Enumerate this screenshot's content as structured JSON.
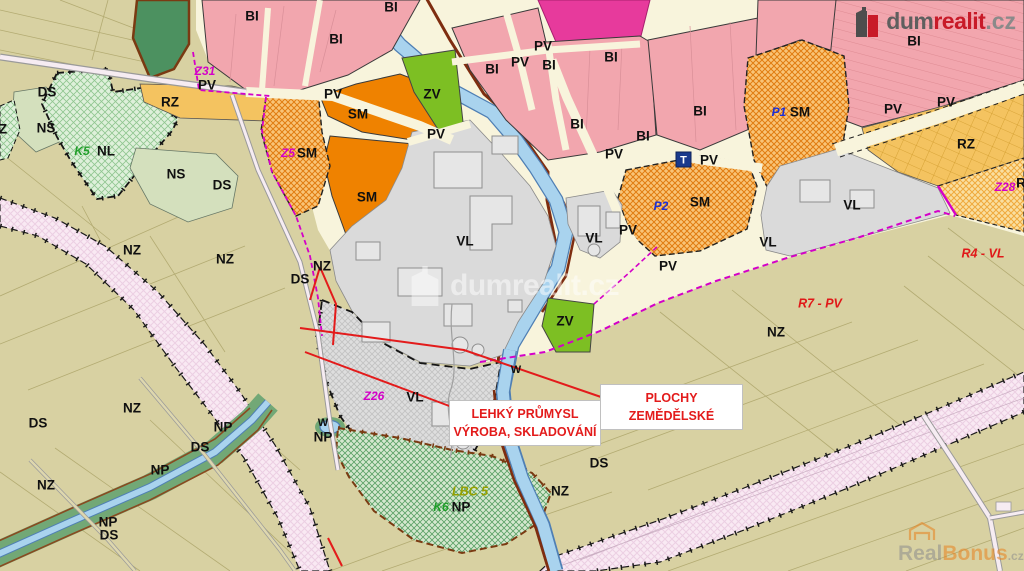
{
  "branding": {
    "logo": {
      "part1": "dum",
      "part2": "realit",
      "part3": ".cz"
    },
    "watermark_center": "dumrealit.cz",
    "watermark_bottom": {
      "part1": "Real",
      "part2": "Bonus",
      "part3": ".cz"
    }
  },
  "annotations": {
    "industry": {
      "line1": "LEHKÝ PRŮMYSL",
      "line2": "VÝROBA, SKLADOVÁNÍ"
    },
    "agriculture": {
      "line1": "PLOCHY",
      "line2": "ZEMĚDĚLSKÉ"
    }
  },
  "map": {
    "t_icon_label": "T",
    "zone_labels": [
      {
        "t": "BI",
        "x": 252,
        "y": 17,
        "c": "z"
      },
      {
        "t": "BI",
        "x": 391,
        "y": 8,
        "c": "z"
      },
      {
        "t": "BI",
        "x": 336,
        "y": 40,
        "c": "z"
      },
      {
        "t": "BI",
        "x": 914,
        "y": 42,
        "c": "z"
      },
      {
        "t": "BI",
        "x": 492,
        "y": 70,
        "c": "z"
      },
      {
        "t": "BI",
        "x": 549,
        "y": 66,
        "c": "z"
      },
      {
        "t": "BI",
        "x": 611,
        "y": 58,
        "c": "z"
      },
      {
        "t": "BI",
        "x": 577,
        "y": 125,
        "c": "z"
      },
      {
        "t": "BI",
        "x": 643,
        "y": 137,
        "c": "z"
      },
      {
        "t": "BI",
        "x": 700,
        "y": 112,
        "c": "z"
      },
      {
        "t": "PV",
        "x": 543,
        "y": 47,
        "c": "z"
      },
      {
        "t": "PV",
        "x": 520,
        "y": 63,
        "c": "z"
      },
      {
        "t": "PV",
        "x": 207,
        "y": 86,
        "c": "z"
      },
      {
        "t": "PV",
        "x": 333,
        "y": 95,
        "c": "z"
      },
      {
        "t": "PV",
        "x": 436,
        "y": 135,
        "c": "z"
      },
      {
        "t": "PV",
        "x": 614,
        "y": 155,
        "c": "z"
      },
      {
        "t": "PV",
        "x": 709,
        "y": 161,
        "c": "z"
      },
      {
        "t": "PV",
        "x": 893,
        "y": 110,
        "c": "z"
      },
      {
        "t": "PV",
        "x": 946,
        "y": 103,
        "c": "z"
      },
      {
        "t": "PV",
        "x": 628,
        "y": 231,
        "c": "z"
      },
      {
        "t": "PV",
        "x": 668,
        "y": 267,
        "c": "z"
      },
      {
        "t": "RZ",
        "x": 170,
        "y": 103,
        "c": "z"
      },
      {
        "t": "RZ",
        "x": 966,
        "y": 145,
        "c": "z"
      },
      {
        "t": "SM",
        "x": 358,
        "y": 115,
        "c": "z"
      },
      {
        "t": "SM",
        "x": 307,
        "y": 154,
        "c": "z"
      },
      {
        "t": "SM",
        "x": 367,
        "y": 198,
        "c": "z"
      },
      {
        "t": "SM",
        "x": 800,
        "y": 113,
        "c": "z"
      },
      {
        "t": "SM",
        "x": 700,
        "y": 203,
        "c": "z"
      },
      {
        "t": "ZV",
        "x": 432,
        "y": 95,
        "c": "z"
      },
      {
        "t": "ZV",
        "x": 565,
        "y": 322,
        "c": "z"
      },
      {
        "t": "VL",
        "x": 465,
        "y": 242,
        "c": "z"
      },
      {
        "t": "VL",
        "x": 594,
        "y": 239,
        "c": "z"
      },
      {
        "t": "VL",
        "x": 852,
        "y": 206,
        "c": "z"
      },
      {
        "t": "VL",
        "x": 768,
        "y": 243,
        "c": "z"
      },
      {
        "t": "VL",
        "x": 415,
        "y": 398,
        "c": "z"
      },
      {
        "t": "DS",
        "x": 47,
        "y": 93,
        "c": "z"
      },
      {
        "t": "DS",
        "x": 222,
        "y": 186,
        "c": "z"
      },
      {
        "t": "DS",
        "x": 300,
        "y": 280,
        "c": "z"
      },
      {
        "t": "DS",
        "x": 599,
        "y": 464,
        "c": "z"
      },
      {
        "t": "DS",
        "x": 38,
        "y": 424,
        "c": "z"
      },
      {
        "t": "DS",
        "x": 200,
        "y": 448,
        "c": "z"
      },
      {
        "t": "DS",
        "x": 109,
        "y": 536,
        "c": "z"
      },
      {
        "t": "NS",
        "x": 46,
        "y": 129,
        "c": "z"
      },
      {
        "t": "NS",
        "x": 176,
        "y": 175,
        "c": "z"
      },
      {
        "t": "NL",
        "x": 106,
        "y": 152,
        "c": "z"
      },
      {
        "t": "NZ",
        "x": 132,
        "y": 251,
        "c": "z"
      },
      {
        "t": "NZ",
        "x": 225,
        "y": 260,
        "c": "z"
      },
      {
        "t": "NZ",
        "x": 322,
        "y": 267,
        "c": "z"
      },
      {
        "t": "NZ",
        "x": 776,
        "y": 333,
        "c": "z"
      },
      {
        "t": "NZ",
        "x": 560,
        "y": 492,
        "c": "z"
      },
      {
        "t": "NZ",
        "x": 132,
        "y": 409,
        "c": "z"
      },
      {
        "t": "NZ",
        "x": 46,
        "y": 486,
        "c": "z"
      },
      {
        "t": "NP",
        "x": 323,
        "y": 438,
        "c": "z"
      },
      {
        "t": "NP",
        "x": 223,
        "y": 428,
        "c": "z"
      },
      {
        "t": "NP",
        "x": 160,
        "y": 471,
        "c": "z"
      },
      {
        "t": "NP",
        "x": 108,
        "y": 523,
        "c": "z"
      },
      {
        "t": "NP",
        "x": 461,
        "y": 508,
        "c": "z"
      },
      {
        "t": "W",
        "x": 323,
        "y": 423,
        "c": "zs"
      },
      {
        "t": "W",
        "x": 516,
        "y": 370,
        "c": "zs"
      },
      {
        "t": "Z",
        "x": 3,
        "y": 130,
        "c": "z"
      },
      {
        "t": "R",
        "x": 1021,
        "y": 184,
        "c": "z"
      },
      {
        "t": "Z31",
        "x": 205,
        "y": 72,
        "c": "m"
      },
      {
        "t": "Z5",
        "x": 288,
        "y": 154,
        "c": "m"
      },
      {
        "t": "Z26",
        "x": 374,
        "y": 397,
        "c": "m"
      },
      {
        "t": "Z28",
        "x": 1005,
        "y": 188,
        "c": "m"
      },
      {
        "t": "P1",
        "x": 779,
        "y": 113,
        "c": "b"
      },
      {
        "t": "P2",
        "x": 661,
        "y": 207,
        "c": "b"
      },
      {
        "t": "K5",
        "x": 82,
        "y": 152,
        "c": "g"
      },
      {
        "t": "K6",
        "x": 441,
        "y": 508,
        "c": "g"
      },
      {
        "t": "LBC 5",
        "x": 470,
        "y": 492,
        "c": "o"
      },
      {
        "t": "R4 - VL",
        "x": 983,
        "y": 254,
        "c": "r"
      },
      {
        "t": "R7 - PV",
        "x": 820,
        "y": 304,
        "c": "r"
      }
    ],
    "colors": {
      "nz_beige": "#d8d1a2",
      "urban_cream": "#f8f4dc",
      "bi_pink": "#f2a6ae",
      "bi_hotpink": "#e73a9c",
      "sm_orange": "#ef8200",
      "rz_yellow": "#f4c360",
      "zv_green": "#7dbf23",
      "vl_grey": "#dadada",
      "water_blue": "#a9d3ee",
      "corridor_pink": "#f9e9f3",
      "green_corridor": "#72a876",
      "boundary_magenta": "#d400c8",
      "annotation_red": "#e31b1b",
      "rail_brown": "#7e2d10"
    }
  }
}
